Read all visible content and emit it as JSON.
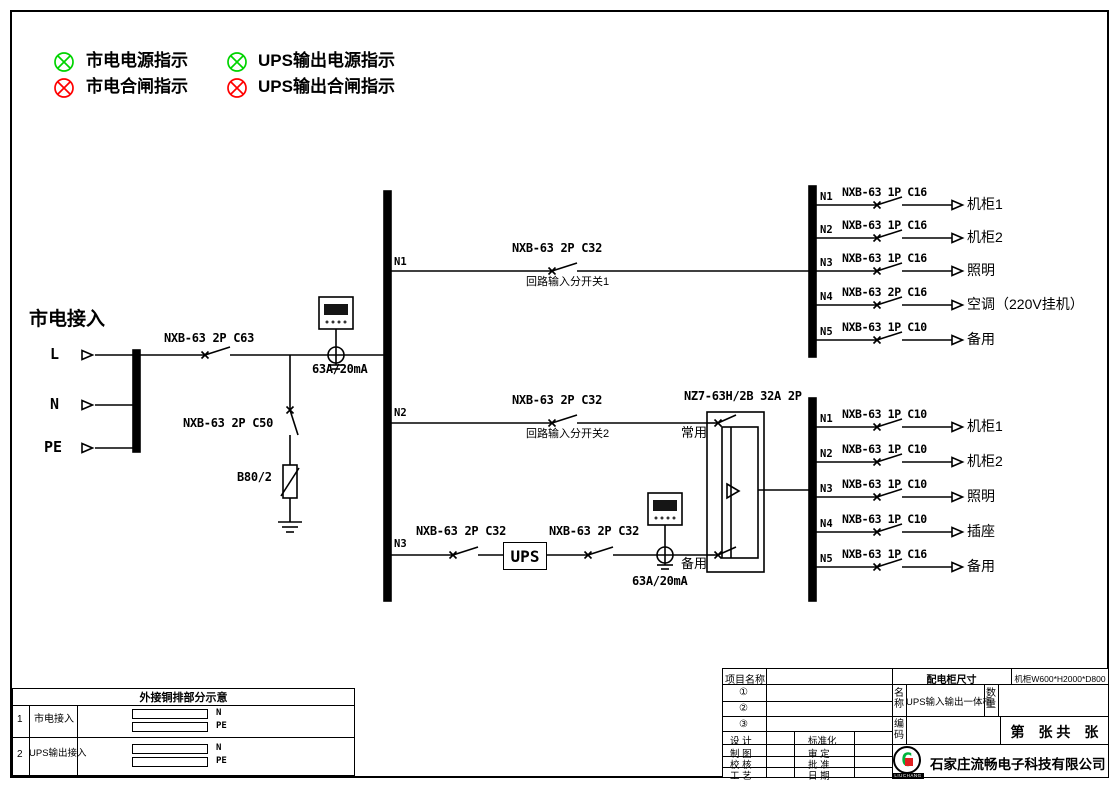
{
  "legend": {
    "items": [
      {
        "label": "市电电源指示",
        "color": "#00d400"
      },
      {
        "label": "UPS输出电源指示",
        "color": "#00d400"
      },
      {
        "label": "市电合闸指示",
        "color": "#ff0000"
      },
      {
        "label": "UPS输出合闸指示",
        "color": "#ff0000"
      }
    ]
  },
  "mains": {
    "title": "市电接入",
    "terminals": [
      "L",
      "N",
      "PE"
    ],
    "main_breaker": "NXB-63 2P C63",
    "spd_breaker": "NXB-63 2P C50",
    "spd_model": "B80/2",
    "leakage_rating": "63A/20mA"
  },
  "feeders": [
    {
      "id": "N1",
      "breaker": "NXB-63 2P C32",
      "note": "回路输入分开关1"
    },
    {
      "id": "N2",
      "breaker": "NXB-63 2P C32",
      "note": "回路输入分开关2"
    },
    {
      "id": "N3",
      "breaker1": "NXB-63 2P C32",
      "ups_label": "UPS",
      "breaker2": "NXB-63 2P C32",
      "leakage_rating": "63A/20mA"
    }
  ],
  "ats": {
    "model": "NZ7-63H/2B 32A 2P",
    "normal": "常用",
    "backup": "备用"
  },
  "top_branches": [
    {
      "id": "N1",
      "breaker": "NXB-63 1P C16",
      "load": "机柜1"
    },
    {
      "id": "N2",
      "breaker": "NXB-63 1P C16",
      "load": "机柜2"
    },
    {
      "id": "N3",
      "breaker": "NXB-63 1P C16",
      "load": "照明"
    },
    {
      "id": "N4",
      "breaker": "NXB-63 2P C16",
      "load": "空调（220V挂机）"
    },
    {
      "id": "N5",
      "breaker": "NXB-63 1P C10",
      "load": "备用"
    }
  ],
  "bottom_branches": [
    {
      "id": "N1",
      "breaker": "NXB-63 1P C10",
      "load": "机柜1"
    },
    {
      "id": "N2",
      "breaker": "NXB-63 1P C10",
      "load": "机柜2"
    },
    {
      "id": "N3",
      "breaker": "NXB-63 1P C10",
      "load": "照明"
    },
    {
      "id": "N4",
      "breaker": "NXB-63 1P C10",
      "load": "插座"
    },
    {
      "id": "N5",
      "breaker": "NXB-63 1P C16",
      "load": "备用"
    }
  ],
  "busbar_table": {
    "title": "外接铜排部分示意",
    "rows": [
      {
        "no": "1",
        "name": "市电接入",
        "bars": [
          "N",
          "PE"
        ]
      },
      {
        "no": "2",
        "name": "UPS输出接入",
        "bars": [
          "N",
          "PE"
        ]
      }
    ]
  },
  "title_block": {
    "project_label": "项目名称",
    "row1": "①",
    "row2": "②",
    "row3": "③",
    "design": "设  计",
    "standardization": "标准化",
    "drafting": "制  图",
    "review": "审  定",
    "check": "校  核",
    "approval": "批  准",
    "craft": "工  艺",
    "date": "日  期",
    "cabinet_size_label": "配电柜尺寸",
    "cabinet_size": "机柜W600*H2000*D800",
    "name_label": "名称",
    "name": "UPS输入输出一体柜",
    "qty_label": "数量",
    "code_label": "编码",
    "sheet": "第　张 共　张",
    "company": "石家庄流畅电子科技有限公司",
    "logo_letter": "G",
    "logo_sub": "LIUCHANG"
  }
}
